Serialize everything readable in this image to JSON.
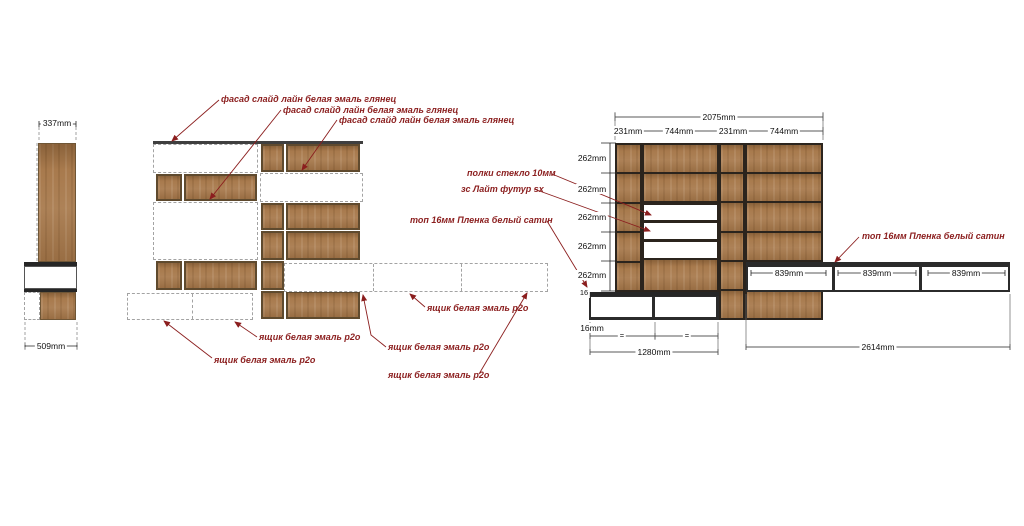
{
  "side_view": {
    "dim_337": "337mm",
    "dim_509": "509mm"
  },
  "middle_view": {
    "fasad_notes": [
      "фасад слайд лайн белая эмаль глянец",
      "фасад слайд лайн белая эмаль глянец",
      "фасад слайд лайн белая эмаль глянец"
    ],
    "drawer_notes": [
      "ящик белая эмаль р2о",
      "ящик белая эмаль р2о",
      "ящик белая эмаль р2о",
      "ящик белая эмаль р2о",
      "ящик белая эмаль р2о"
    ]
  },
  "right_view": {
    "dim_total": "2075mm",
    "col_dims": [
      "231mm",
      "744mm",
      "231mm",
      "744mm"
    ],
    "row_dims": [
      "262mm",
      "262mm",
      "262mm",
      "262mm",
      "262mm"
    ],
    "dim_16": "16",
    "dim_16mm": "16mm",
    "equal_marks": [
      "=",
      "="
    ],
    "dim_1280": "1280mm",
    "dim_2614": "2614mm",
    "lowboard_dims": [
      "839mm",
      "839mm",
      "839mm"
    ],
    "note_shelves": "полки стекло 10мм",
    "note_back": "зс Лайт футур sx",
    "note_top_left": "топ 16мм Пленка белый сатин",
    "note_top_right": "топ 16мм Пленка белый сатин"
  },
  "colors": {
    "wood": "#a87a4d",
    "frame_dark": "#2b241d",
    "annotation_red": "#8b1e1e",
    "band_dark": "#262626"
  }
}
